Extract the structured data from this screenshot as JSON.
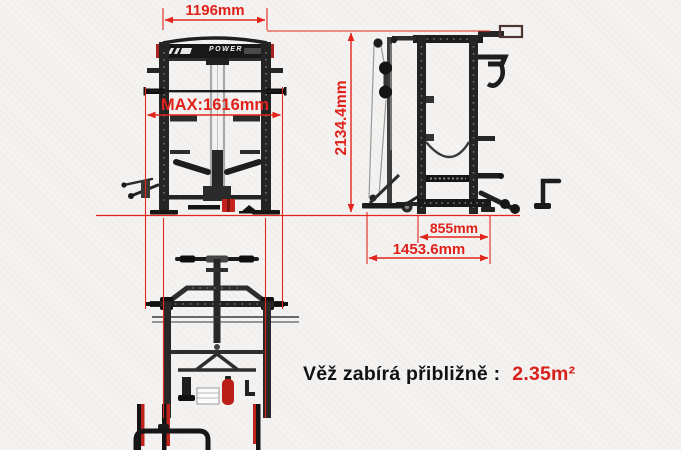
{
  "meta": {
    "description": "Power rack technical dimension diagram (front, side and top views)"
  },
  "colors": {
    "dimension_red": "#e2261d",
    "caption_value_red": "#d8201a",
    "frame_dark": "#242424",
    "background": "#f4f3f1"
  },
  "branding": {
    "plate_text": "POWER"
  },
  "dimensions": {
    "front_width": {
      "label": "1196mm"
    },
    "max_width": {
      "label": "MAX:1616mm"
    },
    "height": {
      "label": "2134.4mm"
    },
    "base_depth": {
      "label": "855mm"
    },
    "total_depth": {
      "label": "1453.6mm"
    }
  },
  "caption": {
    "label": "Věž zabírá přibližně :",
    "value": "2.35m²"
  },
  "views": {
    "front": "front elevation view",
    "side": "side elevation view",
    "top": "top plan view"
  }
}
